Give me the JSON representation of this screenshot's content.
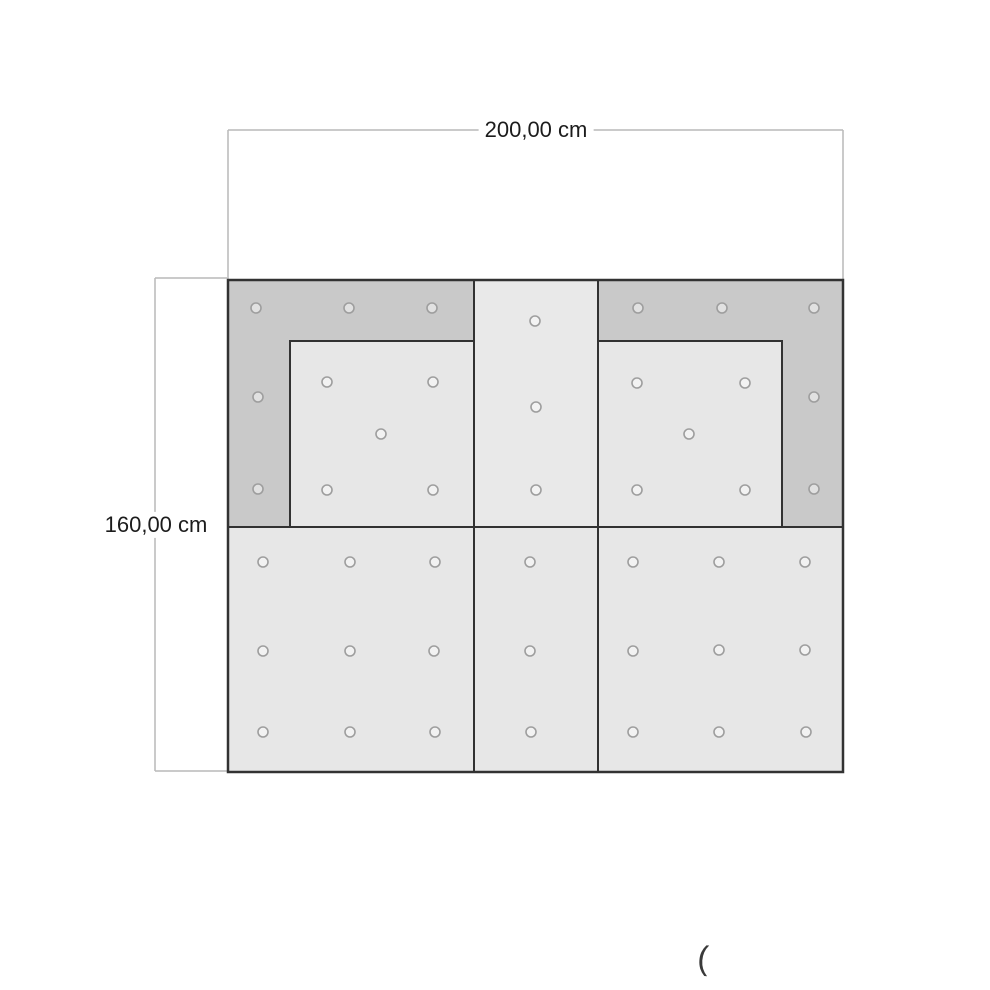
{
  "dimensions": {
    "width_label": "200,00 cm",
    "height_label": "160,00 cm"
  },
  "annotations": {
    "stray_glyph": "("
  },
  "colors": {
    "background": "#ffffff",
    "frame_fill": "#c9c9c9",
    "panel_fill": "#e7e7e7",
    "center_column_fill": "#e9e9e9",
    "panel_border": "#323232",
    "dimension_line": "#b9b9b9",
    "hole_stroke": "#9e9e9e",
    "hole_fill": "rgba(255,255,255,0.45)",
    "label_text": "#1c1c1c"
  },
  "diagram": {
    "outline": {
      "x": 228,
      "y": 280,
      "w": 615,
      "h": 492
    },
    "panels": [
      {
        "name": "upper-left-frame",
        "x": 228,
        "y": 280,
        "w": 246,
        "h": 247,
        "fill": "#c9c9c9"
      },
      {
        "name": "upper-right-frame",
        "x": 598,
        "y": 280,
        "w": 245,
        "h": 247,
        "fill": "#c9c9c9"
      },
      {
        "name": "upper-center-panel",
        "x": 474,
        "y": 280,
        "w": 124,
        "h": 247,
        "fill": "#e9e9e9"
      },
      {
        "name": "lower-left-panel",
        "x": 228,
        "y": 527,
        "w": 246,
        "h": 245,
        "fill": "#e7e7e7"
      },
      {
        "name": "lower-center-panel",
        "x": 474,
        "y": 527,
        "w": 124,
        "h": 245,
        "fill": "#e7e7e7"
      },
      {
        "name": "lower-right-panel",
        "x": 598,
        "y": 527,
        "w": 245,
        "h": 245,
        "fill": "#e7e7e7"
      },
      {
        "name": "upper-left-inner-panel",
        "x": 290,
        "y": 341,
        "w": 184,
        "h": 186,
        "fill": "#e7e7e7"
      },
      {
        "name": "upper-right-inner-panel",
        "x": 598,
        "y": 341,
        "w": 184,
        "h": 186,
        "fill": "#e7e7e7"
      }
    ],
    "holes": [
      {
        "cx": 256,
        "cy": 308
      },
      {
        "cx": 349,
        "cy": 308
      },
      {
        "cx": 432,
        "cy": 308
      },
      {
        "cx": 258,
        "cy": 397
      },
      {
        "cx": 258,
        "cy": 489
      },
      {
        "cx": 327,
        "cy": 382
      },
      {
        "cx": 433,
        "cy": 382
      },
      {
        "cx": 381,
        "cy": 434
      },
      {
        "cx": 327,
        "cy": 490
      },
      {
        "cx": 433,
        "cy": 490
      },
      {
        "cx": 535,
        "cy": 321
      },
      {
        "cx": 536,
        "cy": 407
      },
      {
        "cx": 536,
        "cy": 490
      },
      {
        "cx": 638,
        "cy": 308
      },
      {
        "cx": 722,
        "cy": 308
      },
      {
        "cx": 814,
        "cy": 308
      },
      {
        "cx": 814,
        "cy": 397
      },
      {
        "cx": 814,
        "cy": 489
      },
      {
        "cx": 637,
        "cy": 383
      },
      {
        "cx": 745,
        "cy": 383
      },
      {
        "cx": 689,
        "cy": 434
      },
      {
        "cx": 637,
        "cy": 490
      },
      {
        "cx": 745,
        "cy": 490
      },
      {
        "cx": 263,
        "cy": 562
      },
      {
        "cx": 350,
        "cy": 562
      },
      {
        "cx": 435,
        "cy": 562
      },
      {
        "cx": 263,
        "cy": 651
      },
      {
        "cx": 350,
        "cy": 651
      },
      {
        "cx": 434,
        "cy": 651
      },
      {
        "cx": 263,
        "cy": 732
      },
      {
        "cx": 350,
        "cy": 732
      },
      {
        "cx": 435,
        "cy": 732
      },
      {
        "cx": 530,
        "cy": 562
      },
      {
        "cx": 530,
        "cy": 651
      },
      {
        "cx": 531,
        "cy": 732
      },
      {
        "cx": 633,
        "cy": 562
      },
      {
        "cx": 719,
        "cy": 562
      },
      {
        "cx": 805,
        "cy": 562
      },
      {
        "cx": 633,
        "cy": 651
      },
      {
        "cx": 719,
        "cy": 650
      },
      {
        "cx": 805,
        "cy": 650
      },
      {
        "cx": 633,
        "cy": 732
      },
      {
        "cx": 719,
        "cy": 732
      },
      {
        "cx": 806,
        "cy": 732
      }
    ],
    "dimension_lines": [
      {
        "name": "dim-width-line",
        "x1": 228,
        "y1": 130,
        "x2": 843,
        "y2": 130
      },
      {
        "name": "dim-width-ext-left",
        "x1": 228,
        "y1": 130,
        "x2": 228,
        "y2": 279
      },
      {
        "name": "dim-width-ext-right",
        "x1": 843,
        "y1": 130,
        "x2": 843,
        "y2": 279
      },
      {
        "name": "dim-height-line",
        "x1": 155,
        "y1": 278,
        "x2": 155,
        "y2": 771
      },
      {
        "name": "dim-height-tick-top",
        "x1": 155,
        "y1": 278,
        "x2": 227,
        "y2": 278
      },
      {
        "name": "dim-height-tick-bottom",
        "x1": 155,
        "y1": 771,
        "x2": 227,
        "y2": 771
      }
    ],
    "hole_radius": 5
  }
}
